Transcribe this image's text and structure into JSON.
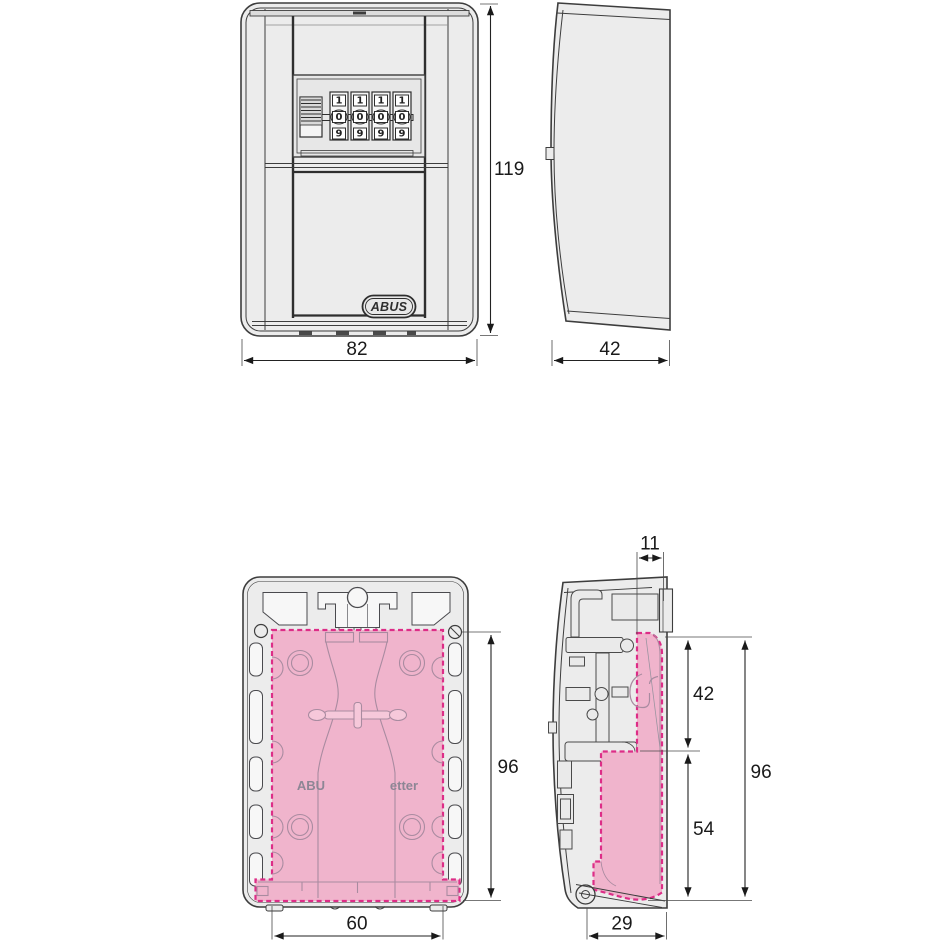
{
  "views": {
    "front": {
      "dim_height": "119",
      "dim_width": "82",
      "logo": "ABUS",
      "dials": [
        {
          "top": "1",
          "mid": "0",
          "bot": "9"
        },
        {
          "top": "1",
          "mid": "0",
          "bot": "9"
        },
        {
          "top": "1",
          "mid": "0",
          "bot": "9"
        },
        {
          "top": "1",
          "mid": "0",
          "bot": "9"
        }
      ]
    },
    "side": {
      "dim_depth": "42"
    },
    "back_interior": {
      "dim_usable_height": "96",
      "dim_usable_width": "60",
      "molded_text_left": "ABU",
      "molded_text_right": "etter"
    },
    "section": {
      "dim_top_depth": "11",
      "dim_upper_height": "42",
      "dim_total_height": "96",
      "dim_lower_height": "54",
      "dim_bottom_depth": "29"
    }
  },
  "colors": {
    "body_fill": "#ececec",
    "outline": "#3d3d3d",
    "highlight_fill": "#f0b4cc",
    "highlight_border": "#dd2d87"
  }
}
